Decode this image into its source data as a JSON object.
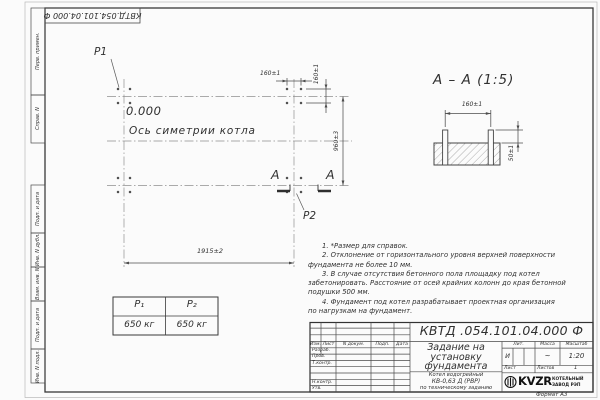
{
  "sheet": {
    "stamp_rotated": "КВТД.054.101.04.000 Ф",
    "format_label": "Формат А3"
  },
  "left_strip": {
    "items": [
      "Перв. примен.",
      "Справ. N",
      "Подп. и дата",
      "Инв. N дубл.",
      "Взам. инв. N",
      "Подп. и дата",
      "Инв. N подл."
    ]
  },
  "plan": {
    "p1": "P1",
    "p2": "P2",
    "elevation": "0.000",
    "axis_label": "Ось симетрии котла",
    "dim_spacing_h": "160±1",
    "dim_spacing_v": "160±1",
    "dim_width": "960±3",
    "dim_length": "1915±2",
    "section_mark": "А"
  },
  "section": {
    "title": "А – А (1:5)",
    "dim_bolt_spacing": "160±1",
    "dim_protrusion": "50±1"
  },
  "notes": {
    "lines": [
      "1. *Размер для справок.",
      "2. Отклонение от горизонтального уровня верхней поверхности",
      "фундамента не более 10 мм.",
      "3. В случае отсутствия бетонного пола площадку под котел",
      "забетонировать. Расстояние от осей крайних колонн до края бетонной",
      "подушки 500 мм.",
      "4. Фундамент под котел разрабатывает проектная организация",
      "по нагрузкам на фундамент."
    ]
  },
  "load_table": {
    "headers": [
      "Р₁",
      "Р₂"
    ],
    "values": [
      "650 кг",
      "650 кг"
    ]
  },
  "title_block": {
    "designation": "КВТД .054.101.04.000  Ф",
    "doc_title": [
      "Задание на",
      "установку",
      "фундамента"
    ],
    "product": [
      "Котел водогрейный",
      "КВ-0,63 Д (РВР)",
      "по техническому заданию"
    ],
    "rev_header": [
      "Изм.",
      "Лист",
      "N докум.",
      "Подп.",
      "Дата"
    ],
    "sign_rows": [
      "Разраб.",
      "Пров.",
      "Т.контр.",
      "Н.контр.",
      "Утв."
    ],
    "props_header": [
      "Лит.",
      "Масса",
      "Масштаб"
    ],
    "lit": "И",
    "mass": "~",
    "scale": "1:20",
    "sheet_label": "Лист",
    "sheets_label": "Листов",
    "sheets_count": "1",
    "logo": {
      "name": "KVZR",
      "line1": "КОТЕЛЬНЫЙ",
      "line2": "ЗАВОД РЭП"
    }
  }
}
